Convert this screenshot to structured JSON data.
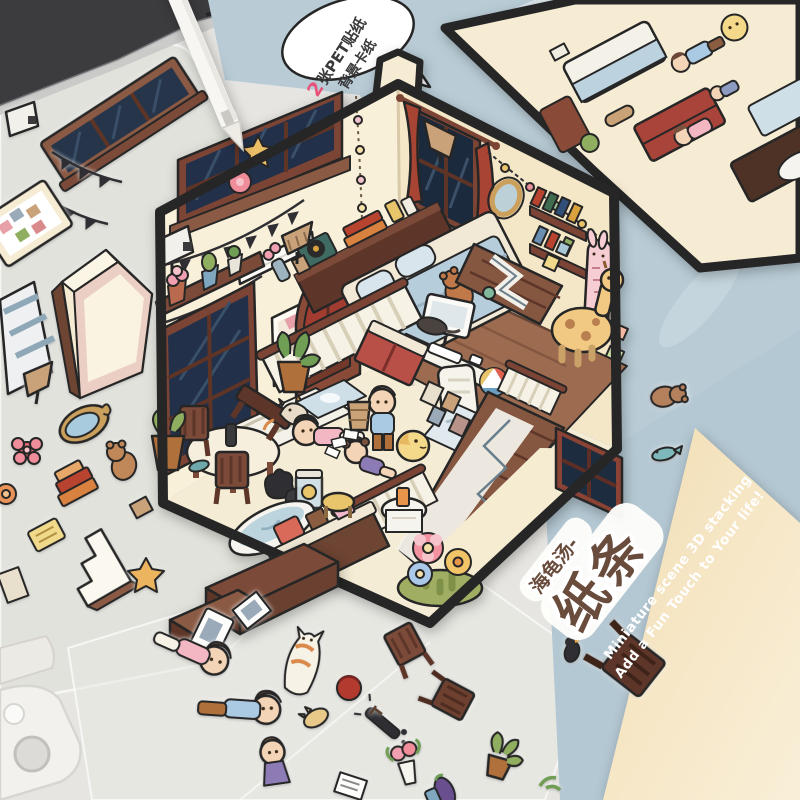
{
  "product": {
    "speech_bubble": {
      "highlight": "2",
      "line1": "张PET贴纸",
      "line2": "背景卡纸"
    },
    "packaging": {
      "series": "海龟汤-",
      "title": "纸条",
      "tagline1": "Miniature scene  3D stacking",
      "tagline2": "Add a Fun Touch to Your life!"
    }
  },
  "colors": {
    "table": "#e6e5e1",
    "packaging_blue": "#b9ccd6",
    "card_cream": "#f3e0bc",
    "hexagon_border": "#262626",
    "wall_cream": "#f8efd8",
    "wood_brown": "#8b5a44",
    "accent_pink": "#e8527a",
    "title_brown": "#6a4c3d"
  }
}
